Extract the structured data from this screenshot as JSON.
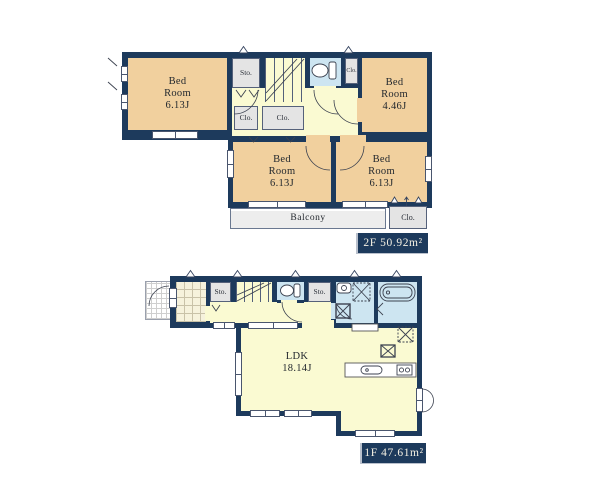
{
  "colors": {
    "wall": "#1d3a5c",
    "bedroom": "#f1d09e",
    "hall": "#fafad2",
    "wet": "#cde5f1",
    "closet": "#e4e4e4",
    "balcony": "#ededed",
    "text": "#23282e",
    "labeltext": "#f3efe2",
    "line": "#3c4250"
  },
  "floor2": {
    "rooms": {
      "bedroom_nw": "Bed\nRoom\n6.13J",
      "bedroom_ne": "Bed\nRoom\n4.46J",
      "bedroom_s": "Bed\nRoom\n6.13J",
      "bedroom_se": "Bed\nRoom\n6.13J",
      "sto": "Sto.",
      "clo_a": "Clo.",
      "clo_b": "Clo.",
      "clo_ne": "Clo.",
      "clo_balcony": "Clo.",
      "balcony": "Balcony"
    },
    "area_label": "2F 50.92m²"
  },
  "floor1": {
    "rooms": {
      "sto_a": "Sto.",
      "sto_b": "Sto.",
      "ldk": "LDK\n18.14J"
    },
    "area_label": "1F 47.61m²"
  }
}
